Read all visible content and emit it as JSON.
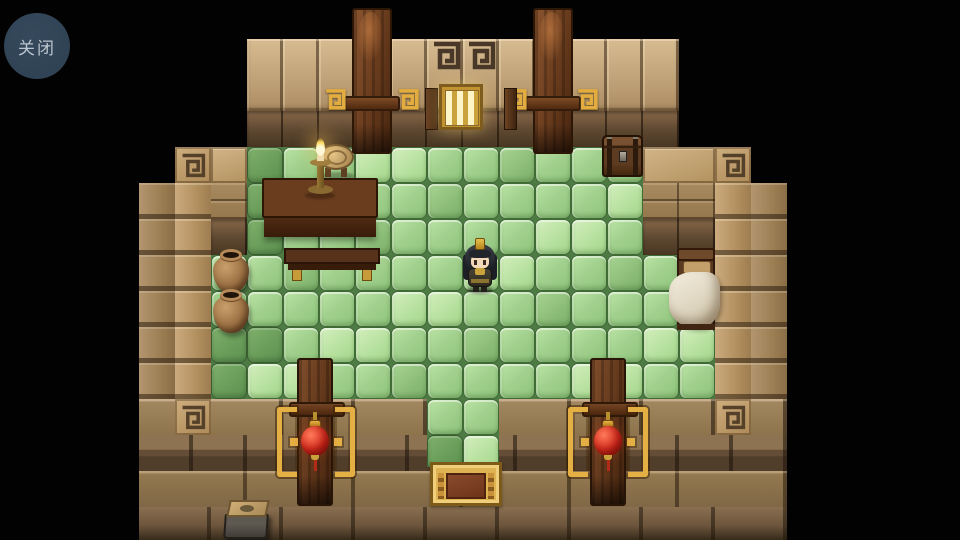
{
  "ui": {
    "close_button": {
      "label": "关闭",
      "bg": "#2f4254",
      "text_color": "#b9c4cc"
    }
  },
  "palette": {
    "background": "#000000",
    "wall_tan": "#bb9c72",
    "wall_shadow": "#5d4730",
    "floor_green": "#a2d18e",
    "floor_shadow_green": "#699c59",
    "wood_dark": "#6b3d1e",
    "gold_accent": "#e4b044",
    "lantern_red": "#d42a1c"
  },
  "scene": {
    "tile_size": 36,
    "walls": [
      {
        "cls": "blocks",
        "name": "top-wall",
        "x": 247,
        "y": 39,
        "w": 432,
        "h": 72
      },
      {
        "cls": "shadowbricks",
        "name": "top-wall-shadow-row",
        "x": 247,
        "y": 111,
        "w": 432,
        "h": 36
      },
      {
        "cls": "blocktile",
        "name": "left-step-block",
        "x": 211,
        "y": 147,
        "w": 36,
        "h": 36
      },
      {
        "cls": "bricks",
        "name": "left-step-bricks",
        "x": 211,
        "y": 183,
        "w": 36,
        "h": 36
      },
      {
        "cls": "shadowbricks",
        "name": "left-step-shadow",
        "x": 211,
        "y": 219,
        "w": 36,
        "h": 36
      },
      {
        "cls": "blocktile",
        "name": "right-step-block",
        "x": 643,
        "y": 147,
        "w": 72,
        "h": 36
      },
      {
        "cls": "bricks",
        "name": "right-step-bricks",
        "x": 643,
        "y": 183,
        "w": 72,
        "h": 36
      },
      {
        "cls": "shadowbricks",
        "name": "right-step-shadow",
        "x": 643,
        "y": 219,
        "w": 72,
        "h": 36
      },
      {
        "cls": "coltiles dk",
        "name": "left-wall-outer",
        "x": 139,
        "y": 183,
        "w": 36,
        "h": 216
      },
      {
        "cls": "coltiles",
        "name": "left-wall-inner",
        "x": 175,
        "y": 183,
        "w": 36,
        "h": 216
      },
      {
        "cls": "coltiles",
        "name": "right-wall-inner",
        "x": 715,
        "y": 183,
        "w": 36,
        "h": 216
      },
      {
        "cls": "coltiles dk",
        "name": "right-wall-outer",
        "x": 751,
        "y": 183,
        "w": 36,
        "h": 216
      },
      {
        "cls": "course1",
        "name": "bottom-wall-row1",
        "x": 139,
        "y": 399,
        "w": 648,
        "h": 36
      },
      {
        "cls": "course2",
        "name": "bottom-wall-row2",
        "x": 139,
        "y": 435,
        "w": 648,
        "h": 36
      },
      {
        "cls": "course3",
        "name": "bottom-wall-row3",
        "x": 139,
        "y": 471,
        "w": 648,
        "h": 36
      },
      {
        "cls": "course4",
        "name": "bottom-wall-row4",
        "x": 139,
        "y": 507,
        "w": 648,
        "h": 33
      }
    ],
    "floors": [
      {
        "name": "floor-upper",
        "x": 247,
        "y": 147,
        "cols": 11,
        "rows": 3
      },
      {
        "name": "floor-main",
        "x": 211,
        "y": 255,
        "cols": 14,
        "rows": 4
      },
      {
        "name": "floor-path",
        "x": 427,
        "y": 399,
        "cols": 2,
        "rows": 2,
        "clip_h": 68
      }
    ],
    "shadow_cells": [
      "247,147",
      "247,183",
      "247,219",
      "211,327",
      "247,327",
      "211,363",
      "427,435"
    ],
    "objects": [
      {
        "type": "crack",
        "name": "wall-crack",
        "x": 256,
        "y": 48,
        "z": 3
      },
      {
        "type": "spiral_dark",
        "name": "wall-spiral-ornament",
        "x": 431,
        "y": 40,
        "z": 3
      },
      {
        "type": "spiral_dark",
        "name": "wall-spiral-ornament",
        "x": 466,
        "y": 40,
        "z": 3
      },
      {
        "type": "spiral_tile",
        "name": "corner-spiral-tile",
        "x": 175,
        "y": 147,
        "z": 3
      },
      {
        "type": "spiral_tile",
        "name": "corner-spiral-tile",
        "x": 715,
        "y": 147,
        "z": 3
      },
      {
        "type": "spiral_tile",
        "name": "corner-spiral-tile",
        "x": 175,
        "y": 399,
        "z": 3
      },
      {
        "type": "spiral_tile",
        "name": "corner-spiral-tile",
        "x": 715,
        "y": 399,
        "z": 3
      },
      {
        "type": "hook",
        "name": "gold-hook-ornament",
        "x": 323,
        "y": 86,
        "z": 7
      },
      {
        "type": "hook",
        "name": "gold-hook-ornament",
        "x": 396,
        "y": 86,
        "z": 7
      },
      {
        "type": "hook",
        "name": "gold-hook-ornament",
        "x": 504,
        "y": 86,
        "z": 7
      },
      {
        "type": "hook",
        "name": "gold-hook-ornament",
        "x": 575,
        "y": 86,
        "z": 7
      },
      {
        "type": "door_top",
        "name": "door-top-left",
        "x": 352,
        "y": 8,
        "z": 6,
        "inter": true
      },
      {
        "type": "door_top",
        "name": "door-top-right",
        "x": 533,
        "y": 8,
        "z": 6,
        "inter": true
      },
      {
        "type": "window",
        "name": "gold-window",
        "x": 425,
        "y": 84,
        "z": 7
      },
      {
        "type": "stool",
        "name": "stool",
        "x": 318,
        "y": 144,
        "z": 4
      },
      {
        "type": "chest",
        "name": "chest",
        "x": 602,
        "y": 135,
        "z": 4,
        "inter": true
      },
      {
        "type": "table",
        "name": "table",
        "x": 262,
        "y": 178,
        "z": 4
      },
      {
        "type": "candle",
        "name": "candlestick",
        "x": 303,
        "y": 136,
        "z": 5
      },
      {
        "type": "bench",
        "name": "bench",
        "x": 284,
        "y": 248,
        "z": 4
      },
      {
        "type": "pot",
        "name": "clay-pot",
        "x": 213,
        "y": 249,
        "z": 4
      },
      {
        "type": "pot",
        "name": "clay-pot",
        "x": 213,
        "y": 289,
        "z": 4
      },
      {
        "type": "bed",
        "name": "bed",
        "x": 675,
        "y": 248,
        "z": 4,
        "inter": true
      },
      {
        "type": "player",
        "name": "player-character",
        "x": 460,
        "y": 238,
        "z": 5,
        "inter": true
      },
      {
        "type": "door_bot",
        "name": "door-bottom-left",
        "x": 297,
        "y": 358,
        "z": 6,
        "inter": true
      },
      {
        "type": "door_bot",
        "name": "door-bottom-right",
        "x": 590,
        "y": 358,
        "z": 6,
        "inter": true
      },
      {
        "type": "bracket",
        "name": "gold-bracket",
        "x": 277,
        "y": 407,
        "z": 7,
        "variant": "l"
      },
      {
        "type": "bracket",
        "name": "gold-bracket",
        "x": 335,
        "y": 407,
        "z": 7,
        "variant": "r"
      },
      {
        "type": "bracket",
        "name": "gold-bracket",
        "x": 568,
        "y": 407,
        "z": 7,
        "variant": "l"
      },
      {
        "type": "bracket",
        "name": "gold-bracket",
        "x": 628,
        "y": 407,
        "z": 7,
        "variant": "r"
      },
      {
        "type": "lantern",
        "name": "red-lantern",
        "x": 300,
        "y": 412,
        "z": 8
      },
      {
        "type": "lantern",
        "name": "red-lantern",
        "x": 593,
        "y": 412,
        "z": 8
      },
      {
        "type": "mat",
        "name": "door-mat",
        "x": 430,
        "y": 462,
        "z": 7,
        "inter": true
      },
      {
        "type": "stone",
        "name": "stone-block",
        "x": 222,
        "y": 500,
        "z": 7
      }
    ]
  }
}
